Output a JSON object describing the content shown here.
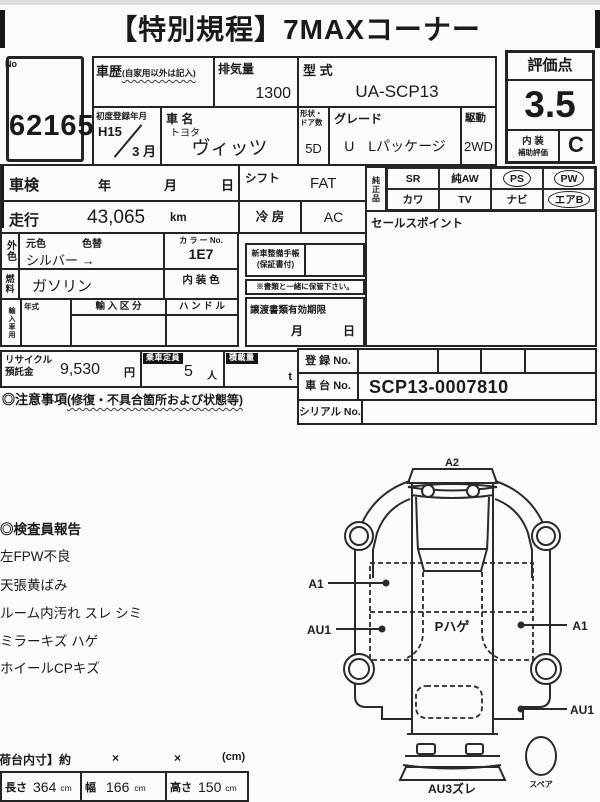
{
  "page": {
    "title": "【特別規程】7MAXコーナー"
  },
  "lot": {
    "no_label": "No",
    "number": "62165"
  },
  "head": {
    "history_label": "車歴",
    "history_note": "(自家用以外は記入)",
    "displacement_label": "排気量",
    "displacement": "1300",
    "model_label": "型 式",
    "model": "UA-SCP13",
    "first_reg_label": "初度登録年月",
    "first_reg_year": "H15",
    "first_reg_month": "3 月",
    "car_label": "車 名",
    "maker": "トヨタ",
    "car": "ヴィッツ",
    "doors_label": "形状・ドア数",
    "doors": "5D",
    "grade_label": "グレード",
    "grade": "U　Lパッケージ",
    "drive_label": "駆動",
    "drive": "2WD"
  },
  "score": {
    "label": "評価点",
    "value": "3.5",
    "interior_label_top": "内 装",
    "interior_label_bottom": "補助評価",
    "interior": "C"
  },
  "check": {
    "shaken_label": "車検",
    "y": "年",
    "m": "月",
    "d": "日",
    "mileage_label": "走行",
    "mileage": "43,065",
    "unit": "km",
    "shift_label": "シフト",
    "shift": "FAT",
    "cool_label": "冷 房",
    "cool": "AC"
  },
  "oem": {
    "label": "純正品",
    "row1": [
      {
        "t": "SR",
        "c": false
      },
      {
        "t": "純AW",
        "c": false
      },
      {
        "t": "PS",
        "c": true
      },
      {
        "t": "PW",
        "c": true
      }
    ],
    "row2": [
      {
        "t": "カワ",
        "c": false
      },
      {
        "t": "TV",
        "c": false
      },
      {
        "t": "ナビ",
        "c": false
      },
      {
        "t": "エアB",
        "c": true
      }
    ]
  },
  "sales": {
    "label": "セールスポイント"
  },
  "exterior": {
    "side": "外色",
    "base_label": "元色",
    "change_label": "色替",
    "base_value": "シルバー →",
    "color_no_label": "カ ラ ー No.",
    "color_no": "1E7"
  },
  "fuel": {
    "side": "燃料",
    "value": "ガソリン",
    "interior_label": "内 装 色"
  },
  "imp": {
    "side": "輸入車用",
    "year_label": "年式",
    "class_label": "輸 入 区 分",
    "handle_label": "ハ ン ド ル"
  },
  "docs": {
    "notebook": "新車整備手帳",
    "warranty": "(保証書付)",
    "keep": "※書類と一緒に保管下さい。",
    "transfer": "譲渡書類有効期限",
    "month": "月",
    "day": "日"
  },
  "recycle": {
    "label1": "リサイクル",
    "label2": "預託金",
    "amount": "9,530",
    "yen": "円",
    "seats_label": "乗車定員",
    "seats": "5",
    "seats_unit": "人",
    "load_label": "積載量",
    "load_unit": "t"
  },
  "reg": {
    "reg_label": "登 録 No.",
    "chassis_label": "車 台 No.",
    "chassis": "SCP13-0007810",
    "serial_label": "シリアル No."
  },
  "caution": {
    "title": "◎注意事項",
    "note": "(修復・不具合箇所および状態等)"
  },
  "report": {
    "title": "◎検査員報告",
    "items": [
      "左FPW不良",
      "天張黄ばみ",
      "ルーム内汚れ スレ シミ",
      "ミラーキズ ハゲ",
      "ホイールCPキズ"
    ]
  },
  "diagram": {
    "a2": "A2",
    "left_a1": "A1",
    "left_au1": "AU1",
    "right_a1": "A1",
    "right_au1": "AU1",
    "roof": "Pハゲ",
    "rear": "AU3ズレ",
    "spare": "スペア"
  },
  "dims": {
    "header": "【荷台内寸】約",
    "x1": "×",
    "x2": "×",
    "unit": "(cm)",
    "len_label": "長さ",
    "len": "364",
    "wid_label": "幅",
    "wid": "166",
    "hei_label": "高さ",
    "hei": "150",
    "cm": "cm"
  }
}
